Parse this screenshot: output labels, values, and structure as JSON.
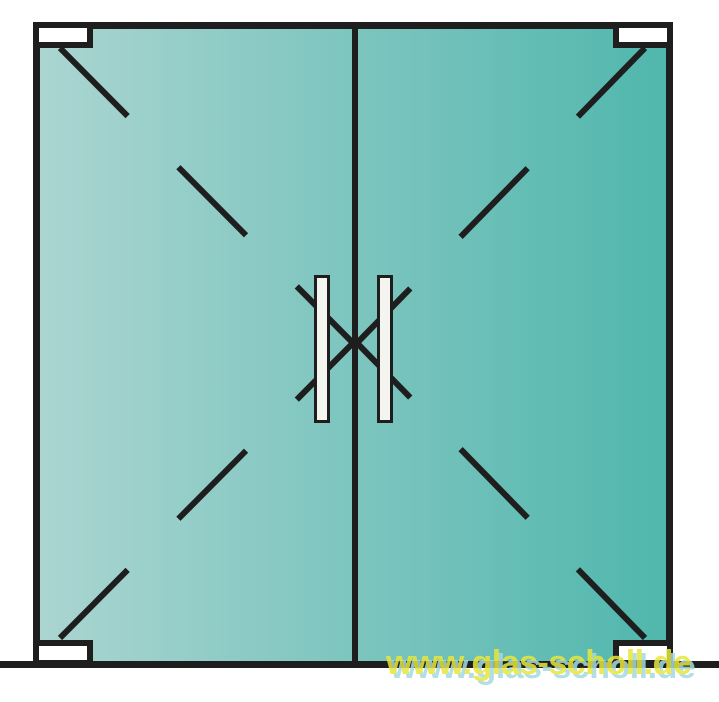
{
  "watermark": {
    "text": "www.glas-scholl.de"
  },
  "colors": {
    "background": "#ffffff",
    "line": "#1e1e1e",
    "glass_left": "#abd5d1",
    "glass_mid": "#7dc5bf",
    "glass_right": "#50b7ad",
    "fitting_fill": "#ffffff",
    "handle_fill": "#f4f4f1",
    "watermark_fill": "#e8e63a",
    "watermark_shadow": "#a5dae2"
  },
  "drawing": {
    "type": "technical-illustration",
    "subject": "double glass swing door, front view, with corner patch fittings and bar handles",
    "doors": [
      {
        "id": "left-door",
        "hinge_side": "left"
      },
      {
        "id": "right-door",
        "hinge_side": "right"
      }
    ],
    "swing_lines": [
      {
        "x1": 60,
        "y1": 48,
        "x2": 353,
        "y2": 343
      },
      {
        "x1": 60,
        "y1": 638,
        "x2": 353,
        "y2": 343
      },
      {
        "x1": 645,
        "y1": 48,
        "x2": 357,
        "y2": 343
      },
      {
        "x1": 645,
        "y1": 638,
        "x2": 357,
        "y2": 343
      }
    ],
    "dash_pattern": "96 72",
    "stroke_width": 6
  }
}
